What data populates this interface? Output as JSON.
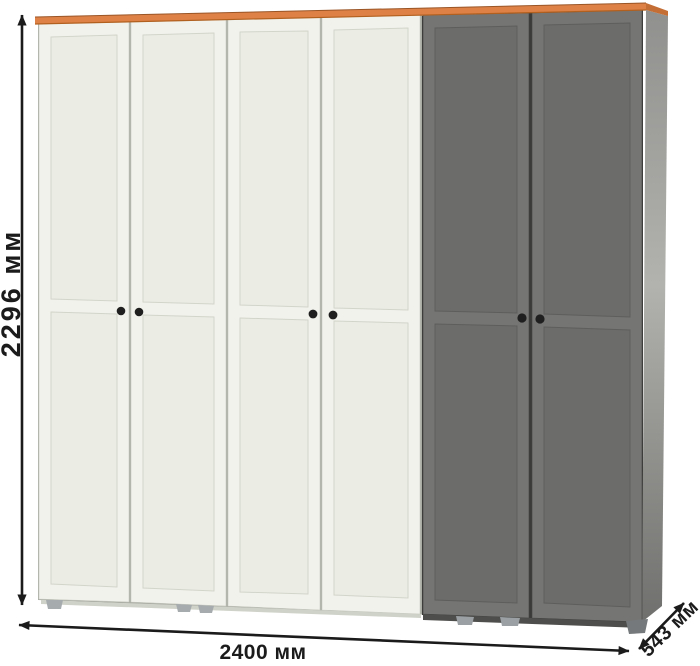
{
  "annotations": {
    "height_label": "2296 мм",
    "width_label": "2400 мм",
    "depth_label": "543 мм"
  },
  "wardrobe": {
    "door_total": 6,
    "doors_white": 4,
    "doors_gray": 2,
    "knob_pairs": 3
  },
  "colors": {
    "background": "#ffffff",
    "top_trim": "#de8147",
    "top_trim_side": "#c46d34",
    "top_trim_shadow": "#b2601f",
    "door_white": "#f1f2ec",
    "door_white_panel": "#ebede5",
    "door_gray": "#757574",
    "door_gray_panel": "#6c6c6b",
    "side_panel_mid": "#b2b2ae",
    "knob": "#1f1f1f",
    "foot": "#a6abae",
    "dimension": "#1b1b1b"
  }
}
